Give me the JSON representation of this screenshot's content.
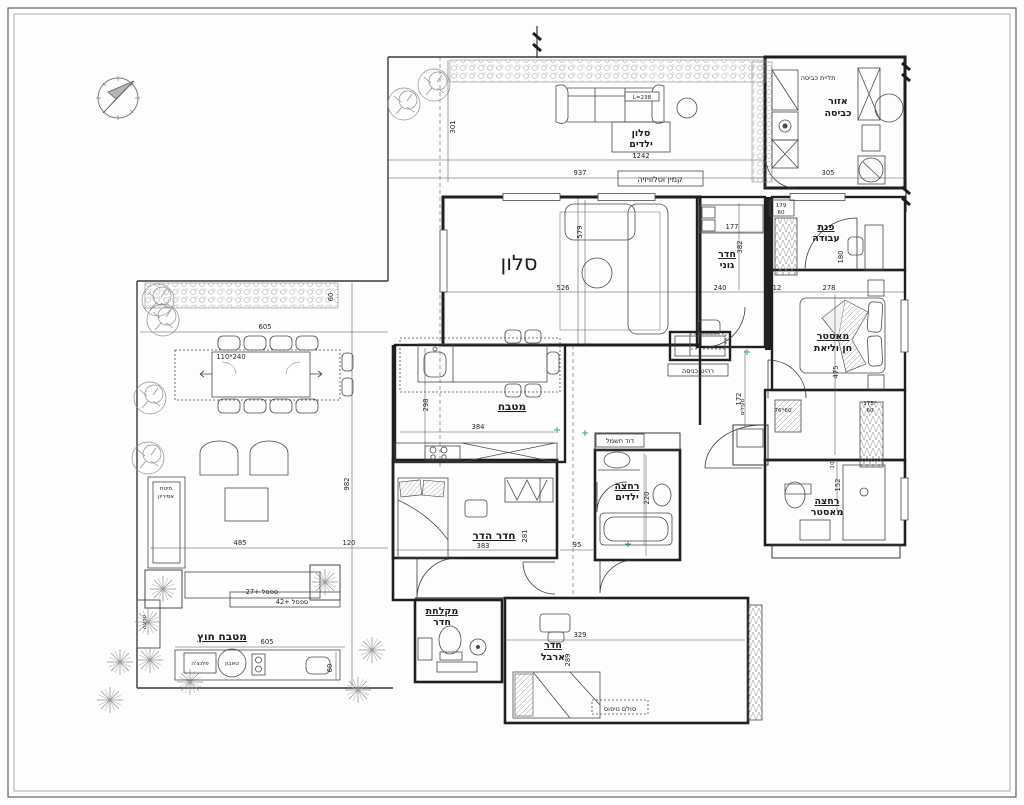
{
  "drawing": {
    "type": "apartment-floor-plan",
    "language": "he"
  },
  "colors": {
    "ink": "#1f1f1f",
    "tick_accent": "#2aa7a0"
  },
  "labels": {
    "kids_lounge_1": "סלון",
    "kids_lounge_2": "ילדים",
    "sofa_len": "L=238",
    "fireplace_tv": "קמין וטלוויזיה",
    "laundry_hang": "תליית כביסה",
    "laundry_area_1": "אזור",
    "laundry_area_2": "כביסה",
    "living": "סלון",
    "goni_1": "חדר",
    "goni_2": "גוני",
    "work_1": "פנת",
    "work_2": "עבודה",
    "master_1": "מאסטר",
    "master_2": "חן וליאת",
    "entry_furniture": "רהיט כניסה",
    "coats": "מעילים",
    "kitchen": "מטבח",
    "boiler": "דוד חשמל",
    "kids_bath_1": "רחצה",
    "kids_bath_2": "ילדים",
    "master_bath_1": "רחצה",
    "master_bath_2": "מאסטר",
    "hadar_room": "חדר הדר",
    "shower_room_1": "מקלחת",
    "shower_room_2": "חדר",
    "arbel_1": "חדר",
    "arbel_2": "ארבל",
    "climbing": "סולם טיפוס",
    "outdoor_kitchen": "מטבח חוץ",
    "plancha": "פלנצ'ה",
    "tabun": "טאבון",
    "bench_27": "ספסל +27",
    "bench_42": "ספסל +42",
    "canopy_1": "מיטת",
    "canopy_2": "אפיריון",
    "flowerbed": "ערוגה"
  },
  "dims": {
    "d301": "301",
    "d1242": "1242",
    "d937": "937",
    "d305": "305",
    "d579": "579",
    "d526": "526",
    "d177": "177",
    "d382": "382",
    "d240": "240",
    "d12": "12",
    "d278": "278",
    "d179": "179",
    "d179b": "60",
    "d180": "180",
    "d172": "172",
    "d475": "475",
    "d76_60": "76*60",
    "d175": "175*",
    "d175b": "60",
    "d152": "152",
    "d10": "10",
    "d298": "298",
    "d384": "384",
    "d220": "220",
    "d95": "95",
    "d383": "383",
    "d281": "281",
    "d329": "329",
    "d289": "289",
    "d605_top": "605",
    "d605_bottom": "605",
    "d110_240": "110*240",
    "d60_top": "60",
    "d60_bottom": "60",
    "d982": "982",
    "d485": "485",
    "d120": "120"
  }
}
